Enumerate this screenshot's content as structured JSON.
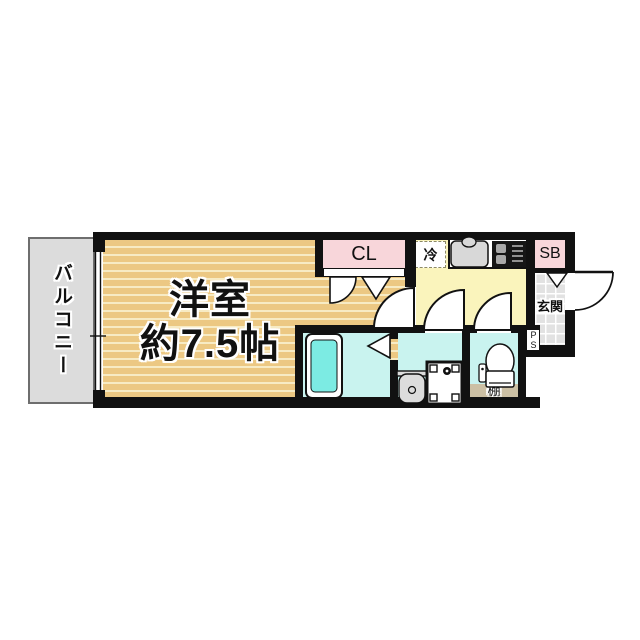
{
  "labels": {
    "balcony": "バルコニー",
    "room_line1": "洋室",
    "room_line2": "約7.5帖",
    "closet": "CL",
    "refrigerator": "冷",
    "shoe_box": "SB",
    "entrance": "玄関",
    "pipe_space": "PS",
    "shelf": "棚"
  },
  "colors": {
    "wall": "#111111",
    "room_floor": "#ECC883",
    "room_floor_stripe": "#F7EBC4",
    "closet_pink": "#F8D6DA",
    "kitchen_yellow": "#FAF4BC",
    "wet_area_cyan": "#C9F3EF",
    "bathtub_cyan": "#7CEBE3",
    "balcony_gray": "#DCDCDC",
    "entrance_tile_gray": "#E2E2E2",
    "shelf_tan": "#CCC0A4"
  }
}
